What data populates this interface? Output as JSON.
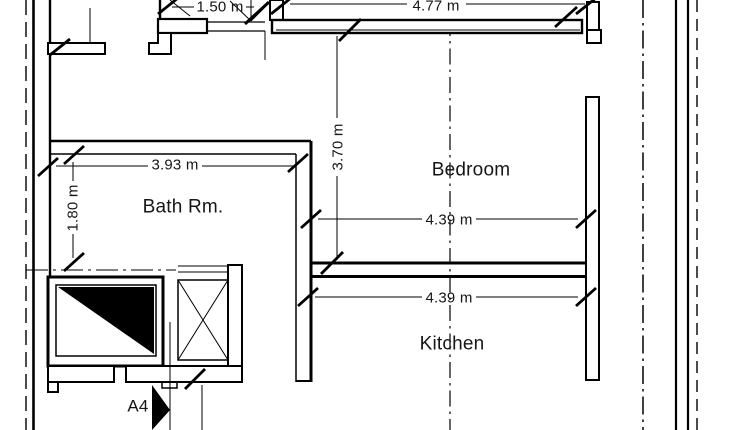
{
  "drawing": {
    "type": "architectural-floor-plan",
    "rooms": {
      "bath": "Bath Rm.",
      "bedroom": "Bedroom",
      "kitchen": "Kitchen"
    },
    "dimensions": {
      "landing_width": "1.50 m",
      "top_wall_width": "4.77 m",
      "bedroom_depth": "3.70 m",
      "bath_width": "3.93 m",
      "bath_depth": "1.80 m",
      "bedroom_width": "4.39 m",
      "kitchen_width": "4.39 m"
    },
    "markers": {
      "section_label": "A4"
    },
    "symbols": {
      "elevator": "elevator-shaft-triangle",
      "staircase": "stair-x-cross",
      "section_arrow": "section-cut-arrow"
    },
    "colors": {
      "line": "#000000",
      "background": "#ffffff"
    }
  }
}
